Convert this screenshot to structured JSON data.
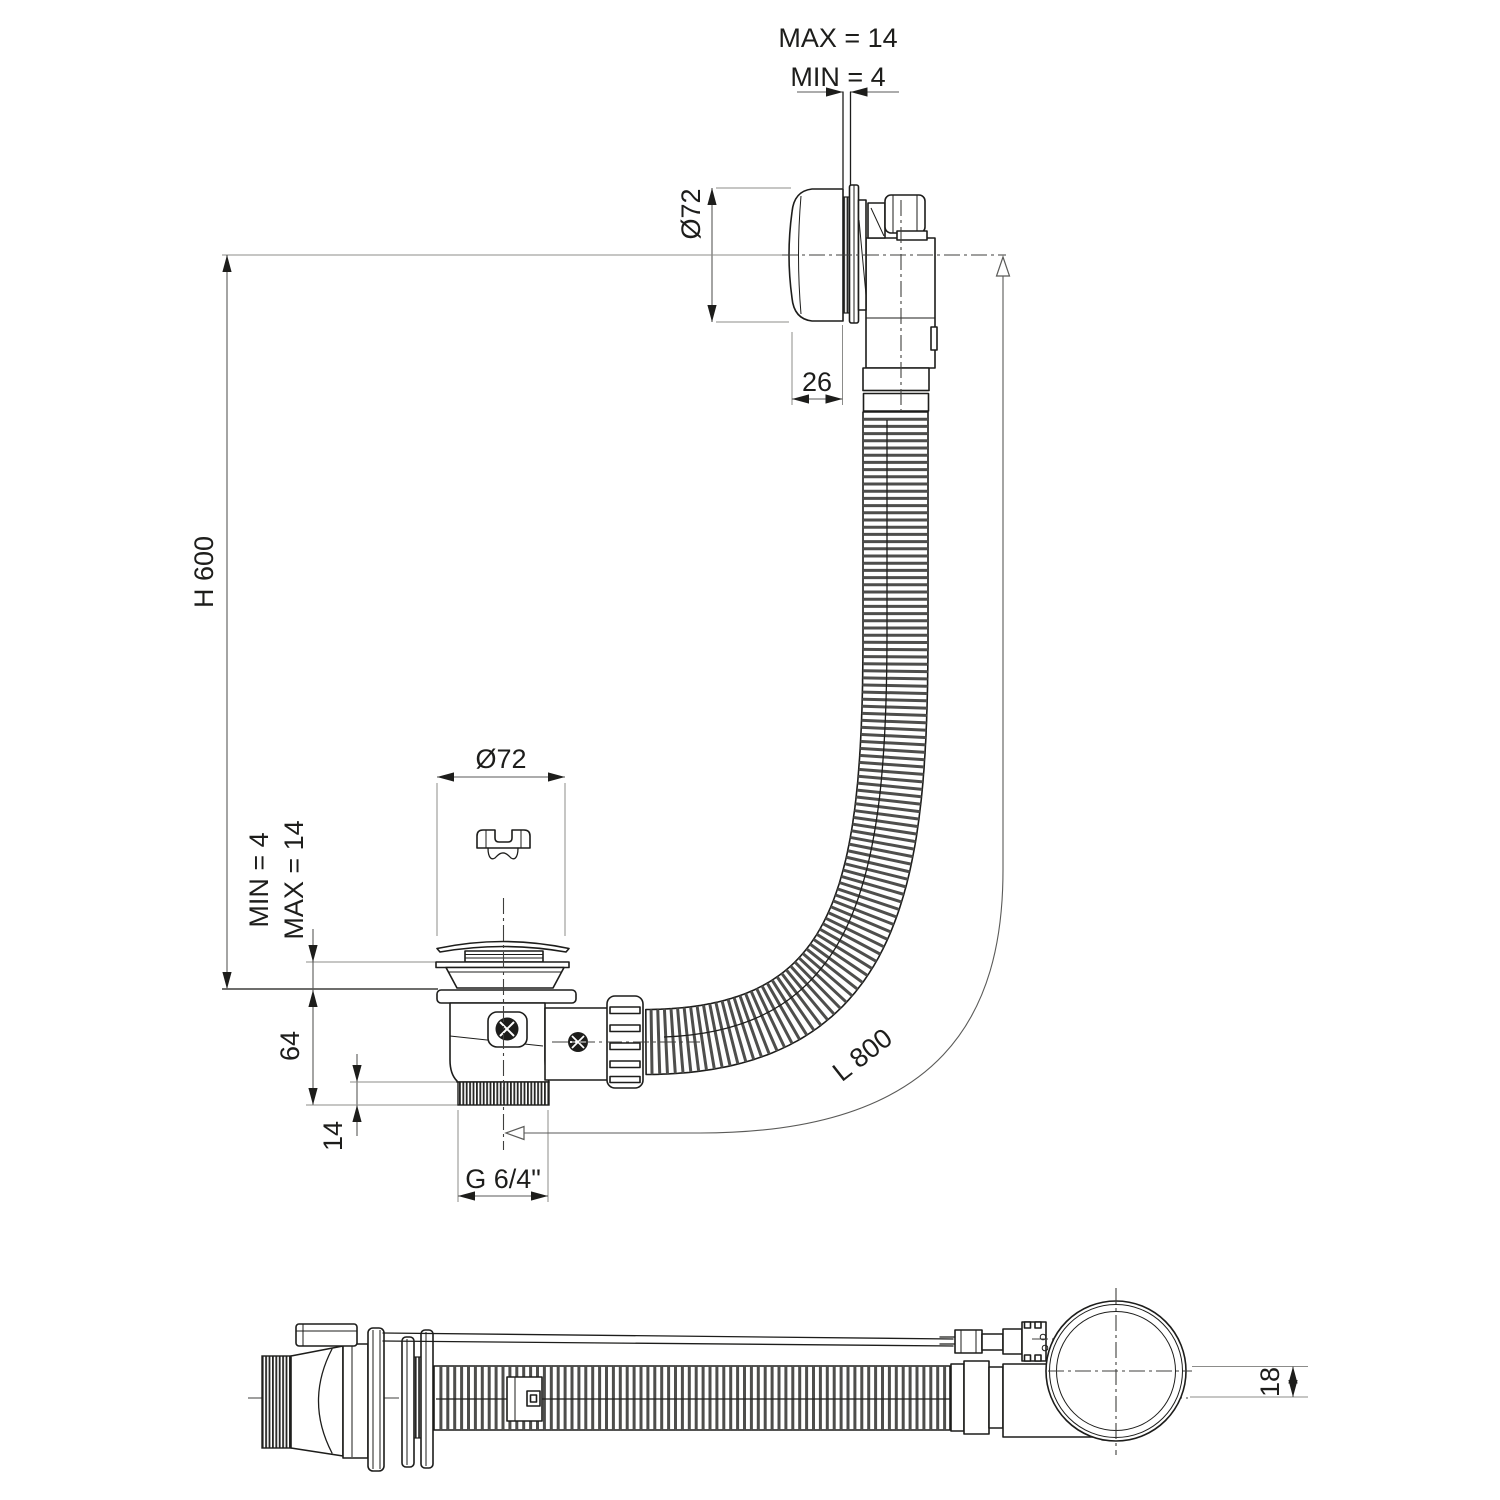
{
  "drawing": {
    "description": "Dimensional line drawing of a bath waste and overflow set with flexible corrugated hose, side view and bottom view",
    "labels": {
      "wall_thickness_max": "MAX = 14",
      "wall_thickness_min": "MIN =  4",
      "overflow_trim_diameter": "Ø72",
      "overflow_depth": "26",
      "overall_height": "H 600",
      "waste_trim_diameter": "Ø72",
      "bottom_thickness_min": "MIN = 4",
      "bottom_thickness_max": "MAX = 14",
      "waste_body_height": "64",
      "thread_length": "14",
      "thread_size": "G 6/4\"",
      "hose_length": "L 800",
      "overflow_housing_height": "18"
    },
    "colors": {
      "line": "#1d1d1b",
      "dimension": "#5a5a58",
      "extension": "#8c8c8a",
      "rib": "#4e4e4c",
      "background": "#ffffff"
    }
  }
}
